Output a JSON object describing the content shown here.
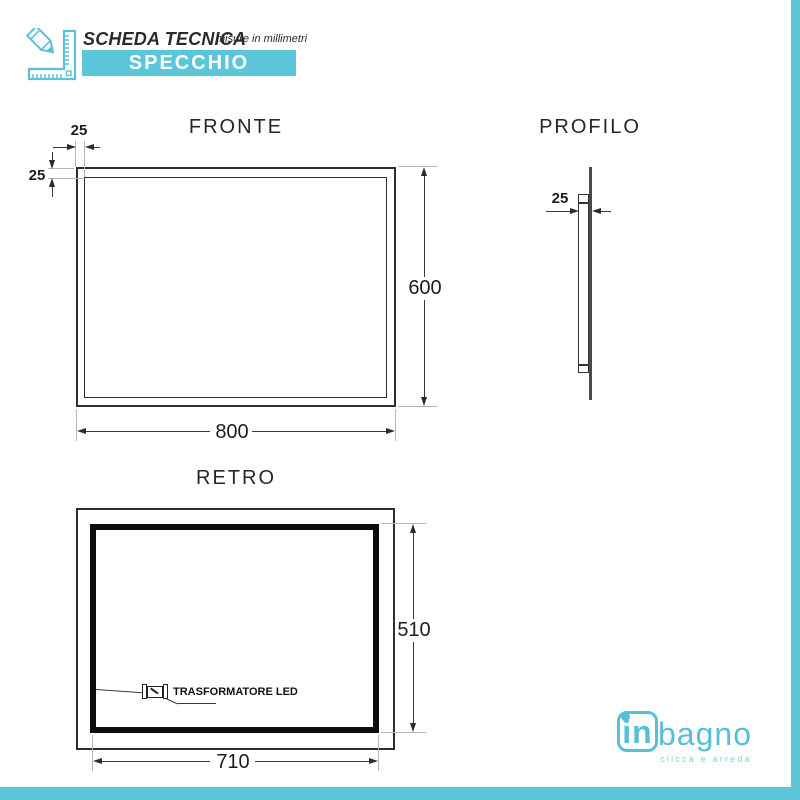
{
  "header": {
    "title": "SCHEDA TECNICA",
    "subtitle": "misure in millimetri",
    "banner": "SPECCHIO"
  },
  "views": {
    "fronte": {
      "title": "FRONTE",
      "dims": {
        "frame_top": "25",
        "frame_left": "25",
        "height": "600",
        "width": "800"
      }
    },
    "profilo": {
      "title": "PROFILO",
      "dims": {
        "depth": "25"
      }
    },
    "retro": {
      "title": "RETRO",
      "dims": {
        "inner_height": "510",
        "inner_width": "710"
      },
      "transformer_label": "TRASFORMATORE LED"
    }
  },
  "footer": {
    "logo_in": "in",
    "logo_bagno": "bagno",
    "tagline": "clicca e arreda"
  },
  "colors": {
    "teal": "#5bc5da",
    "logo_teal": "#58bfd8",
    "tagline_teal": "#85d1e3",
    "line_dark": "#2e2e2e"
  }
}
